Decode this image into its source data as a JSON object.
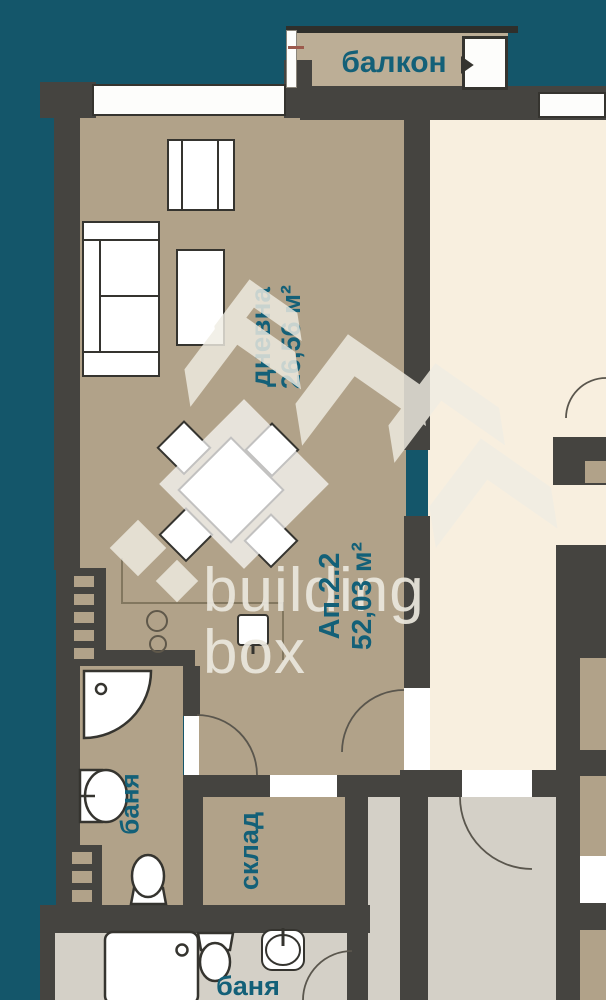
{
  "plan": {
    "watermark": {
      "line1": "building",
      "line2": "box"
    },
    "rooms": {
      "balcony": {
        "label": "балкон"
      },
      "living": {
        "label": "дневна",
        "area": "26,56 м²"
      },
      "apartment": {
        "label": "Ап.2.2",
        "area": "52,03 м²"
      },
      "bath_left": {
        "label": "баня"
      },
      "storage": {
        "label": "склад"
      },
      "bath_bottom": {
        "label": "баня"
      }
    },
    "colors": {
      "background": "#14566a",
      "floor_tan": "#b1a289",
      "floor_balcony": "#bcae96",
      "floor_cream": "#f8efdf",
      "floor_gray": "#d4d0c7",
      "wall": "#454440",
      "label_text": "#136078",
      "watermark": "#f0ede3"
    }
  }
}
